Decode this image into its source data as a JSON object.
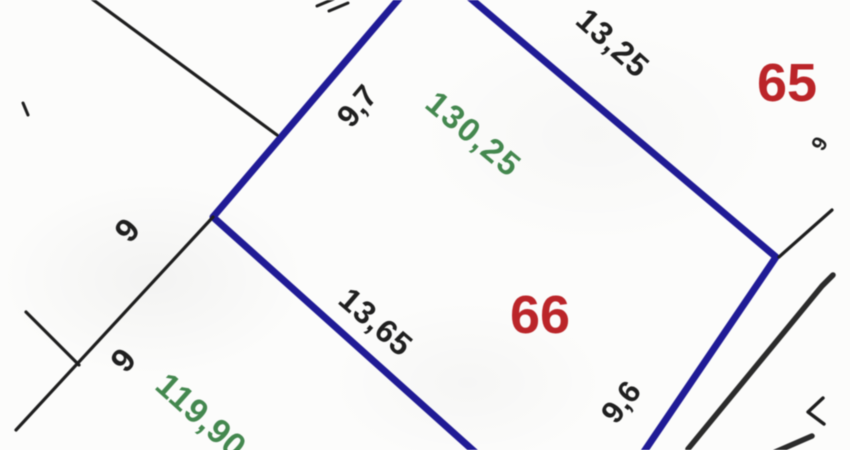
{
  "map": {
    "background": "#fcfcfb",
    "blur_px": 0.55,
    "colors": {
      "parcel_boundary_selected": "#201b96",
      "boundary": "#1e1e1e",
      "road": "#2b2b2b",
      "parcel_number": "#bb2529",
      "measurement": "#1f1f1f",
      "green_value": "#44884f"
    },
    "parcel_numbers": [
      "65",
      "66"
    ],
    "measurements": [
      "13,25",
      "9,7",
      "130,25",
      "9",
      "13,65",
      "9",
      "9,6",
      "119,90",
      "9"
    ],
    "labels": [
      {
        "name": "length-13-25",
        "text": "13,25",
        "x": 613,
        "y": 43,
        "rot": 42,
        "color": "measurement",
        "size": 32,
        "spacing": 1
      },
      {
        "name": "parcel-number-65",
        "text": "65",
        "x": 787,
        "y": 83,
        "rot": 0,
        "color": "parcel_number",
        "size": 54,
        "spacing": 0,
        "interactable": true
      },
      {
        "name": "length-9-7",
        "text": "9,7",
        "x": 357,
        "y": 106,
        "rot": -50,
        "color": "measurement",
        "size": 31,
        "spacing": 0
      },
      {
        "name": "green-value-130-25",
        "text": "130,25",
        "x": 474,
        "y": 134,
        "rot": 40,
        "color": "green_value",
        "size": 33,
        "spacing": 2
      },
      {
        "name": "length-9-upper",
        "text": "9",
        "x": 127,
        "y": 230,
        "rot": -50,
        "color": "measurement",
        "size": 33,
        "spacing": 0
      },
      {
        "name": "parcel-number-66",
        "text": "66",
        "x": 540,
        "y": 315,
        "rot": 0,
        "color": "parcel_number",
        "size": 54,
        "spacing": 0,
        "interactable": true
      },
      {
        "name": "length-13-65",
        "text": "13,65",
        "x": 376,
        "y": 322,
        "rot": 41,
        "color": "measurement",
        "size": 32,
        "spacing": 1
      },
      {
        "name": "length-9-lower",
        "text": "9",
        "x": 123,
        "y": 360,
        "rot": -50,
        "color": "measurement",
        "size": 33,
        "spacing": 0
      },
      {
        "name": "length-9-6",
        "text": "9,6",
        "x": 621,
        "y": 402,
        "rot": -52,
        "color": "measurement",
        "size": 31,
        "spacing": 0
      },
      {
        "name": "green-value-119-90",
        "text": "119,90",
        "x": 201,
        "y": 416,
        "rot": 42,
        "color": "green_value",
        "size": 34,
        "spacing": 1
      },
      {
        "name": "length-9-edge",
        "text": "9",
        "x": 820,
        "y": 144,
        "rot": -60,
        "color": "measurement",
        "size": 21,
        "spacing": 0
      }
    ],
    "lines": [
      {
        "name": "parcel-66-boundary-west",
        "points": "432,-40 213,217 486,462",
        "color": "parcel_boundary_selected",
        "width": 7,
        "interactable": true
      },
      {
        "name": "parcel-66-boundary-east",
        "points": "437,-30 776,257 637,462",
        "color": "parcel_boundary_selected",
        "width": 7,
        "interactable": true
      },
      {
        "name": "boundary-northwest",
        "points": "88,-4 277,135",
        "color": "boundary",
        "width": 3.2
      },
      {
        "name": "boundary-southwest",
        "points": "213,217 16,430",
        "color": "boundary",
        "width": 3.2
      },
      {
        "name": "boundary-branch-west",
        "points": "26,312 79,365",
        "color": "boundary",
        "width": 3.2
      },
      {
        "name": "boundary-northeast",
        "points": "832,210 779,257",
        "color": "boundary",
        "width": 3.2
      },
      {
        "name": "survey-tick-left",
        "points": "23,103 28,115",
        "color": "boundary",
        "width": 3
      },
      {
        "name": "clipped-glyph-top-a",
        "points": "317,6 336,-2",
        "color": "boundary",
        "width": 3
      },
      {
        "name": "clipped-glyph-top-b",
        "points": "329,11 348,3",
        "color": "boundary",
        "width": 3
      },
      {
        "name": "road-edge",
        "points": "833,275 822,286 688,449",
        "color": "road",
        "width": 5.5
      },
      {
        "name": "road-edge-lower",
        "points": "766,456 812,436",
        "color": "road",
        "width": 5.5
      },
      {
        "name": "clipped-glyph-right",
        "points": "823,398 808,412 824,424",
        "color": "boundary",
        "width": 3.4
      }
    ]
  }
}
